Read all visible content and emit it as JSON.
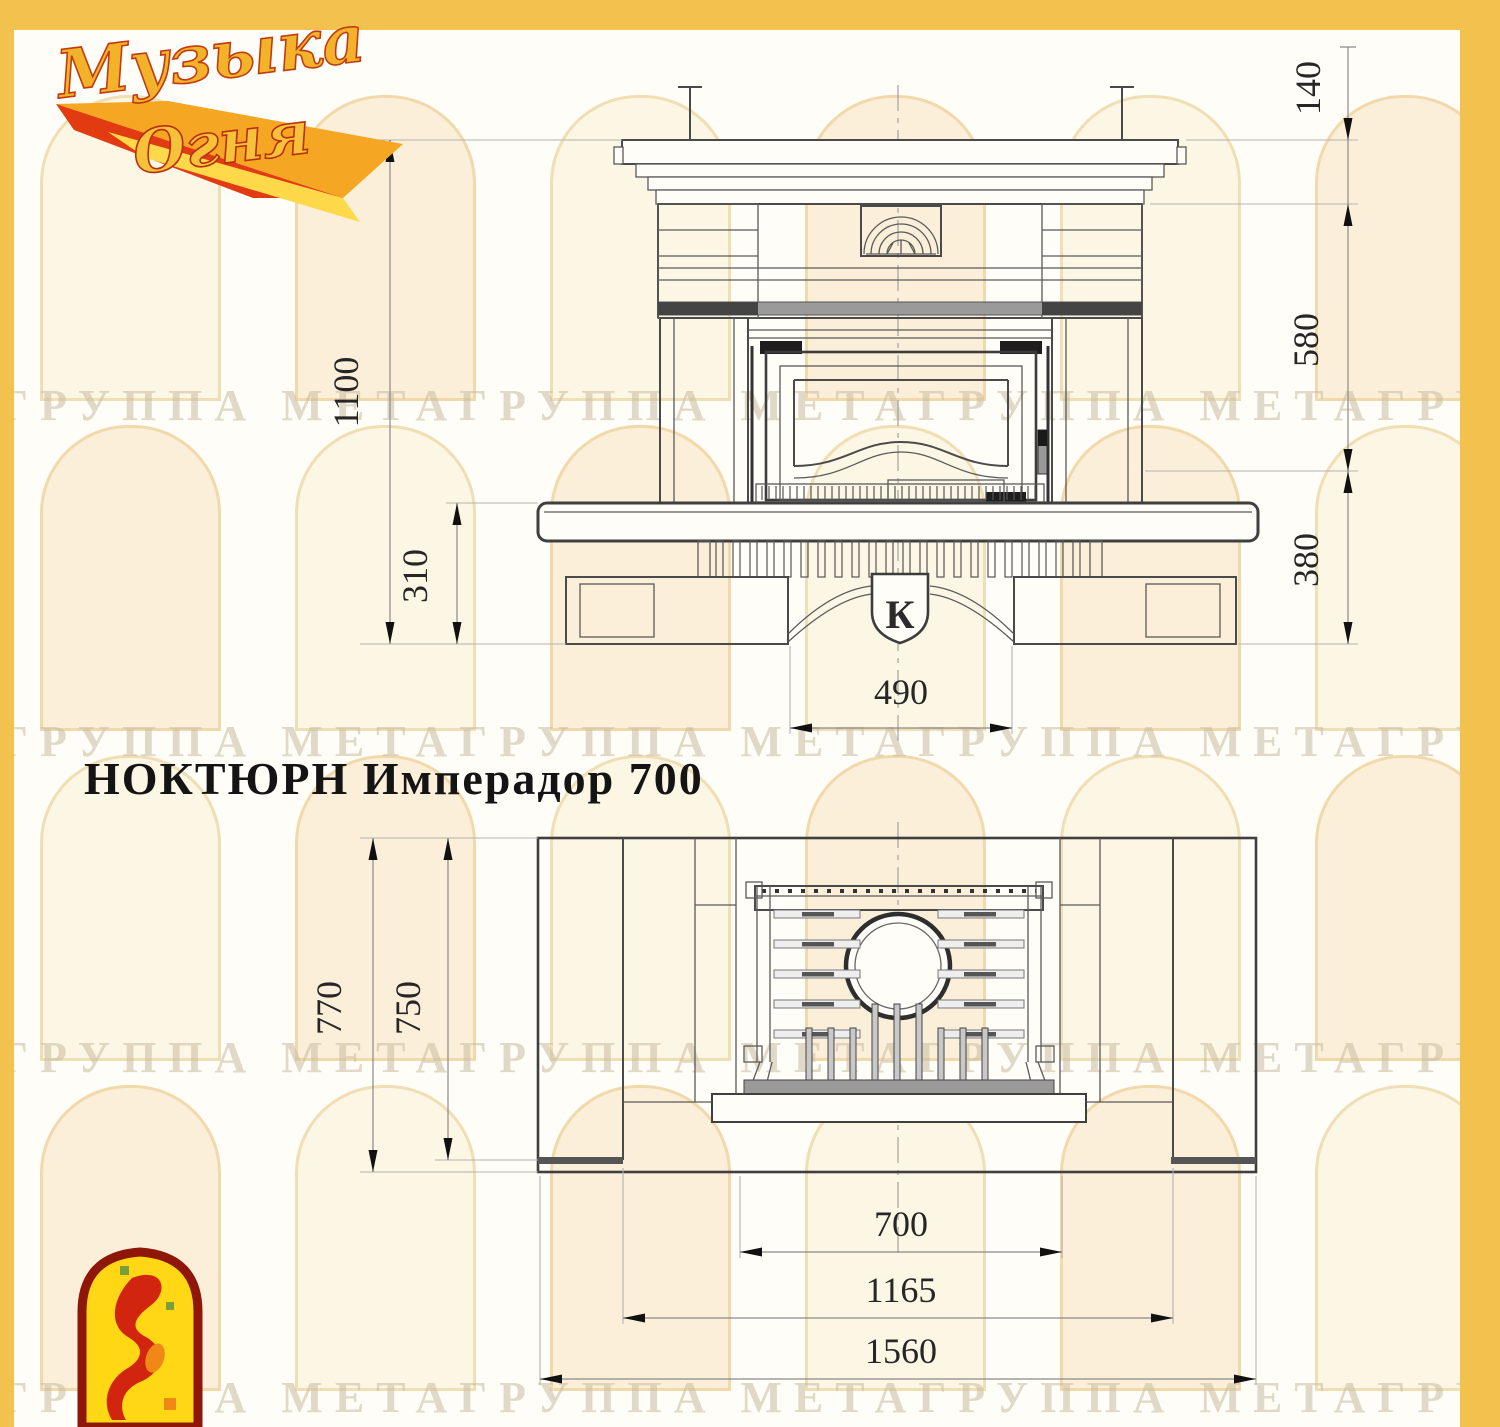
{
  "page": {
    "title": "НОКТЮРН Имперадор 700"
  },
  "brand": {
    "logo_line1": "Музыка",
    "logo_line2": "Огня"
  },
  "watermark": {
    "text": "ГРУППА МЕТАГРУППА МЕТАГРУППА МЕТАГРУППА МЕТАГРУППА МЕТА"
  },
  "front_view": {
    "emblem_letter": "К",
    "dims": {
      "total_height": "1100",
      "hearth_height": "310",
      "cornice_height": "140",
      "portal_height": "580",
      "base_height": "380",
      "pedestal_width": "490"
    }
  },
  "plan_view": {
    "dims": {
      "depth_outer": "770",
      "depth_inner": "750",
      "firebox_width": "700",
      "body_width": "1165",
      "total_width": "1560"
    }
  },
  "colors": {
    "frame_yellow": "#F2C14E",
    "line_dark": "#4a4a4a",
    "dim_gray": "#8a8a8a",
    "logo_red": "#D2250F",
    "logo_gold": "#F2B32A"
  }
}
